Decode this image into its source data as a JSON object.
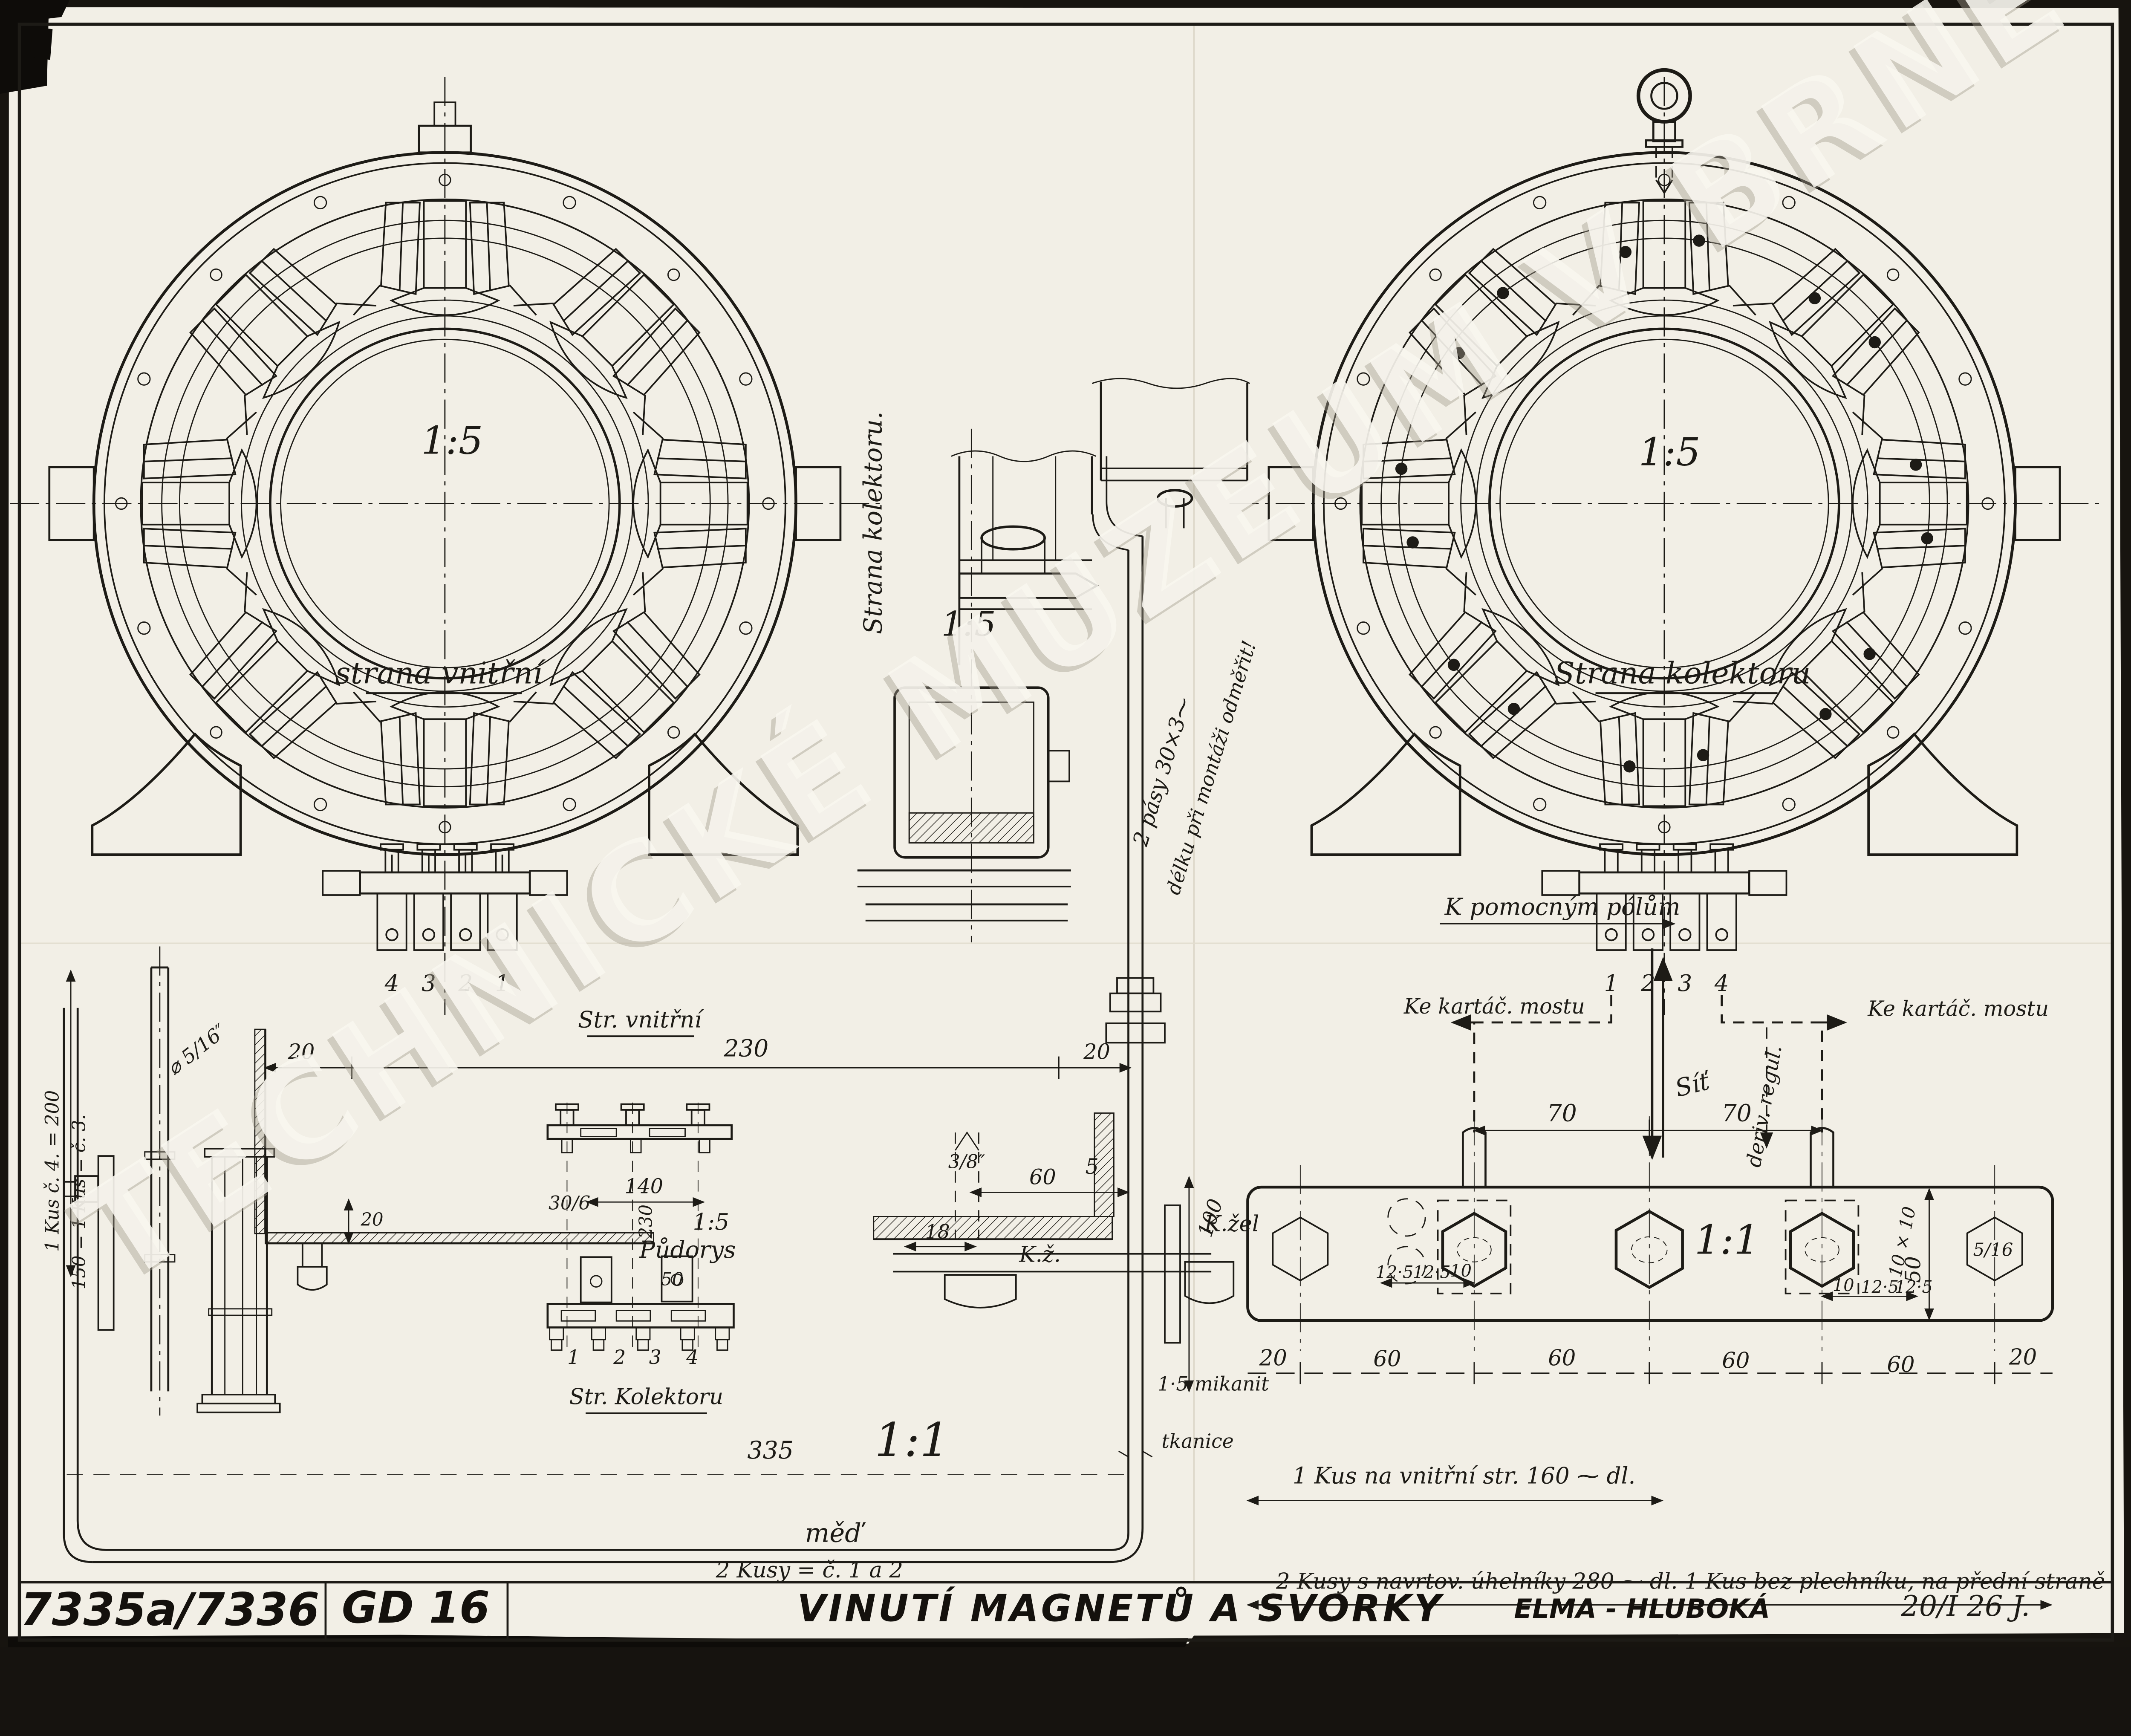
{
  "watermark": {
    "text": "TECHNICKÉ MUZEUM V BRNĚ"
  },
  "title_block": {
    "drawing_number": "7335a/7336",
    "code": "GD 16",
    "title": "VINUTÍ MAGNETŮ A SVORKY",
    "company": "ELMA - HLUBOKÁ",
    "date": "20/I 26 J."
  },
  "views": {
    "left": {
      "scale": "1:5",
      "caption": "strana vnitřní"
    },
    "right": {
      "scale": "1:5",
      "caption": "Strana kolektoru"
    },
    "section": {
      "scale": "1:5",
      "caption": "Strana kolektoru."
    },
    "plan": {
      "scale": "1:5",
      "caption": "Půdorys",
      "top_caption": "Str. vnitřní",
      "bottom_caption": "Str. Kolektoru"
    },
    "detail": {
      "scale": "1:1"
    },
    "strip": {
      "scale": "1:1"
    }
  },
  "notes": {
    "strips": "2 pásy 30×3⁓",
    "measure_on_site": "délku při montáži odměřit!",
    "aux_poles": "K pomocným pólům",
    "brush_bridge": "Ke kartáč. mostu",
    "mains": "Síť",
    "shunt_reg": "deriv. regul.",
    "kz": "K.ž.",
    "kzel": "K.žel",
    "mica": "1·5 mikanit",
    "tape": "tkanice",
    "copper": "měď",
    "pieces_1_2": "2 Kusy = č. 1 a 2",
    "piece_4": "1 Kus č. 4. = 200",
    "piece_3": "150 = 1 Kus = č. 3.",
    "inner_piece": "1 Kus na vnitřní str. 160 ⁓ dl.",
    "outer_pieces": "2 Kusy s navrtov. úhelníky 280 ⁓ dl.  1 Kus bez plechníku, na přední straně"
  },
  "dims": {
    "5": "5",
    "10": "10",
    "18": "18",
    "20": "20",
    "50": "50",
    "60": "60",
    "70": "70",
    "100": "100",
    "140": "140",
    "230": "230",
    "335": "335",
    "12_5": "12·5",
    "30_6": "30/6",
    "10x10": "10 × 10",
    "thread_3_8": "3/8″",
    "thread_5_16_d": "⌀ 5/16″",
    "thread_5_16": "5/16"
  },
  "terminals": {
    "left": [
      "4",
      "3",
      "2",
      "1"
    ],
    "right": [
      "1",
      "2",
      "3",
      "4"
    ],
    "plan": [
      "1",
      "2",
      "3",
      "4"
    ]
  }
}
